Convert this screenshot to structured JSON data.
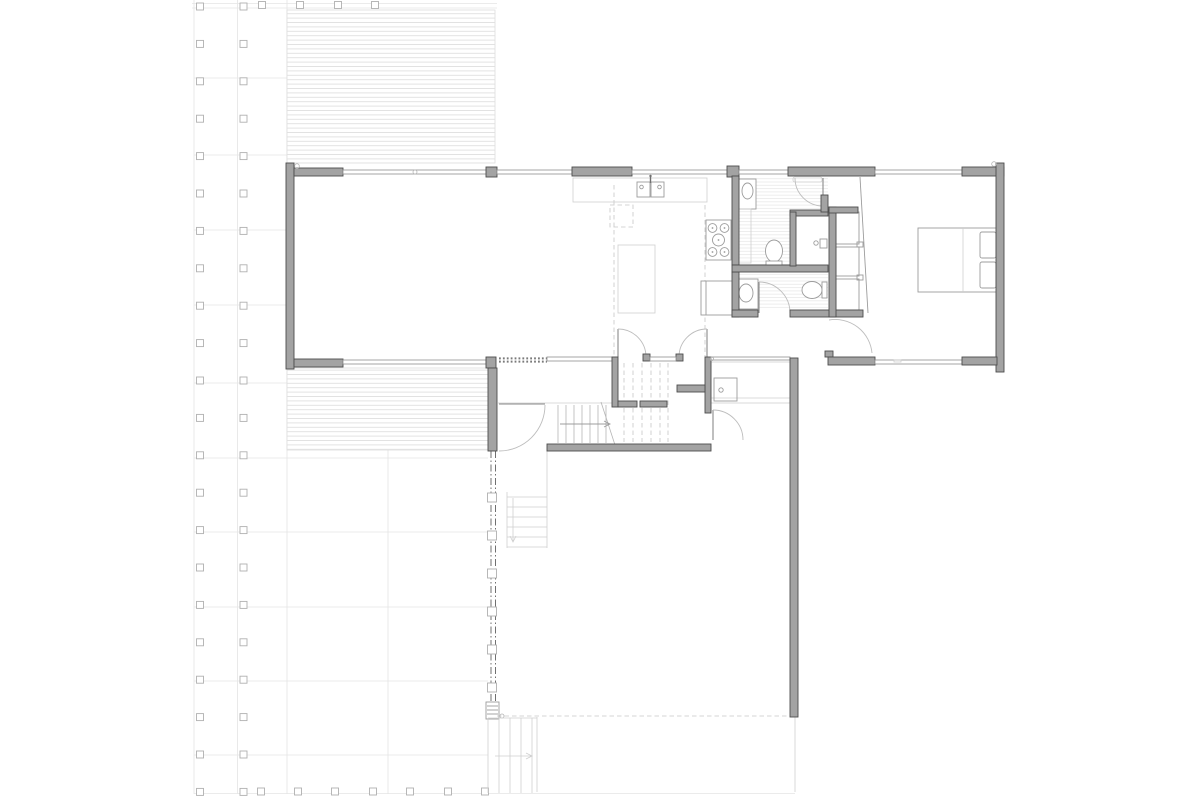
{
  "document": {
    "type": "architectural floor plan drawing",
    "level": "main floor plan",
    "style": "CAD greyscale line drawing, no text labels"
  },
  "colors": {
    "background": "#ffffff",
    "wall_fill": "#a3a3a3",
    "wall_outline": "#4d4d4d",
    "window_line": "#8f8f8f",
    "fixture_line": "#9c9c9c",
    "light_line": "#cfcfcf",
    "site_grid_line": "#e4e4e4",
    "deck_hatch": "#e0e0e0",
    "tile_hatch": "#ebebeb",
    "dashed_reference": "#c6c6c6",
    "screen_centerline": "#707070"
  },
  "elements": {
    "decks": [
      "upper-deck-hatched",
      "lower-deck-hatched"
    ],
    "rooms": [
      "living-room",
      "kitchen",
      "bathroom",
      "shower-room",
      "second-bathroom",
      "hallway",
      "bedroom",
      "entry-vestibule",
      "stair-hall",
      "lower-court",
      "patio"
    ],
    "fixtures": [
      "kitchen-sink",
      "range-cooktop",
      "refrigerator",
      "kitchen-island",
      "range-hood-dashed",
      "bathroom-vanity-sink",
      "toilet",
      "shower-valve",
      "laundry-counter-sink",
      "double-bed-with-pillows",
      "closet-shelves",
      "entry-double-doors",
      "interior-door-swings",
      "main-stairs",
      "exterior-steps"
    ],
    "site": [
      "post-column-grid",
      "garden-grid-lines",
      "screen-wall-centerline",
      "threshold",
      "direction-arrows"
    ]
  }
}
